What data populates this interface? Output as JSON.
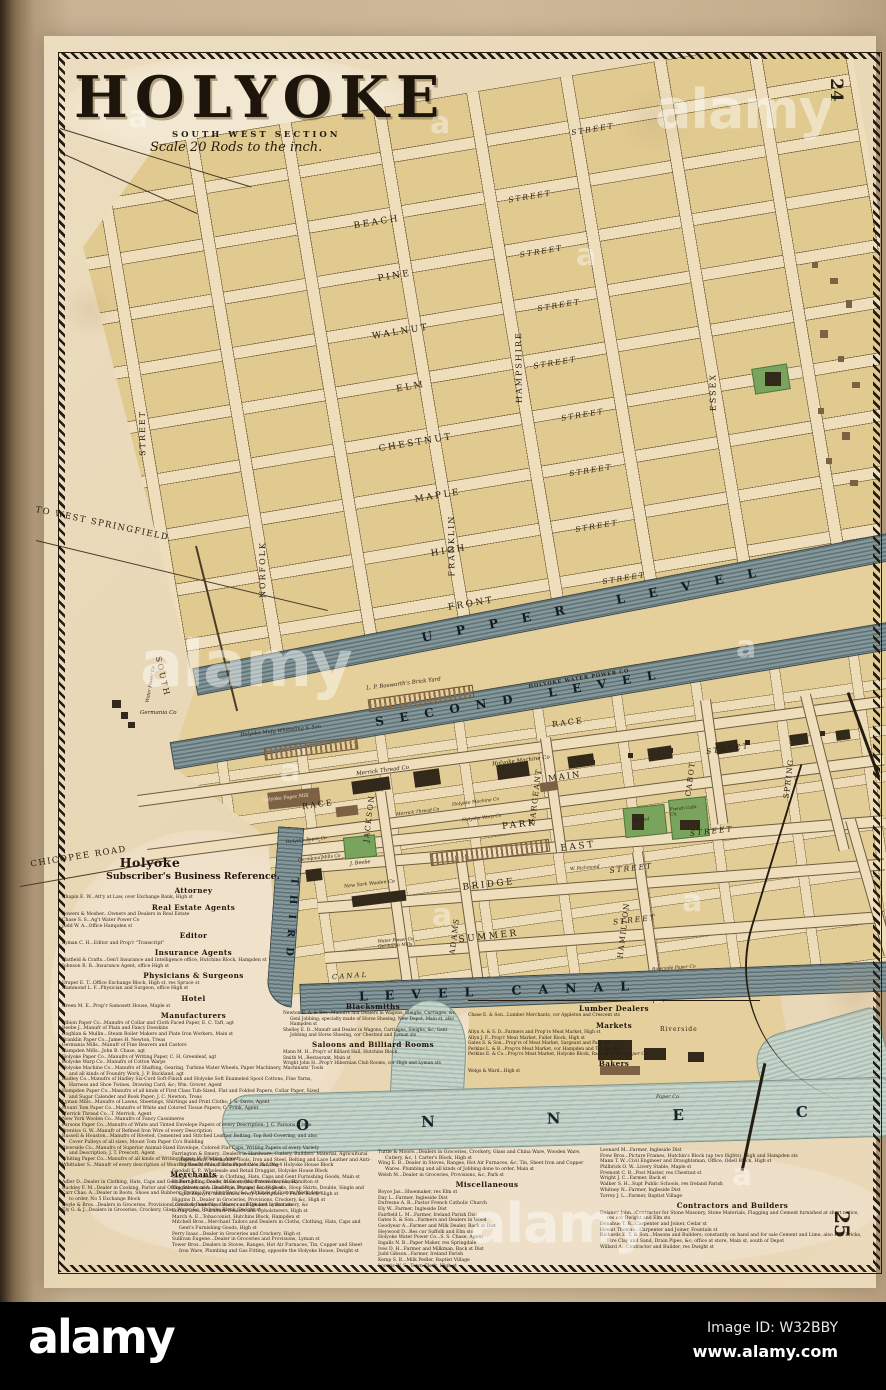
{
  "sheet": {
    "title": "HOLYOKE",
    "section": "SOUTH WEST SECTION",
    "scale": "Scale 20 Rods to the inch.",
    "page_top": "24",
    "page_bottom": "25"
  },
  "watermark": {
    "wordmark": "alamy",
    "glyph": "a",
    "image_id": "Image ID: W32BBY",
    "site": "www.alamy.com"
  },
  "map": {
    "rows": [
      {
        "s": "STREET"
      },
      {
        "n": "BEACH",
        "s": "STREET"
      },
      {
        "n": "PINE",
        "s": "STREET"
      },
      {
        "n": "WALNUT",
        "s": "STREET"
      },
      {
        "n": "ELM",
        "s": "STREET"
      },
      {
        "n": "CHESTNUT",
        "s": "STREET"
      },
      {
        "n": "MAPLE",
        "s": "STREET"
      },
      {
        "n": "HIGH",
        "s": "STREET"
      },
      {
        "n": "FRONT",
        "s": "STREET"
      }
    ],
    "cols": [
      "STREET",
      "NORFOLK",
      "FRANKLIN",
      "HAMPSHIRE",
      "ESSEX",
      "STREET"
    ],
    "lower_rows": [
      {
        "n": "PARK"
      },
      {
        "n": "EAST",
        "s": "STREET"
      },
      {
        "n": "BRIDGE",
        "s": "STREET"
      },
      {
        "n": "SUMMER",
        "s": "STREET"
      }
    ],
    "lower_cols": [
      "JACKSON",
      "SARGEANT",
      "ADAMS",
      "CABOT",
      "HAMILTON",
      "SPRING"
    ],
    "canals": {
      "upper": "UPPER LEVEL",
      "second": "SECOND LEVEL",
      "first": "LEVEL CANAL",
      "third": "THIRD",
      "canal_st": "CANAL"
    },
    "river_letters": "ONNEC",
    "roads": {
      "west_springfield": "TO WEST SPRINGFIELD",
      "chicopee": "CHICOPEE ROAD",
      "south": "SOUTH"
    },
    "streets_mid": {
      "race": "RACE",
      "race2": "RACE",
      "main": "MAIN",
      "main_st": "STREET"
    },
    "places": {
      "hwp": "HOLYOKE WATER POWER CO",
      "bosworth": "L. P. Bosworth's Brick Yard",
      "germania_co": "Germania Co",
      "holyoke_mnfg": "Holyoke Mnfg Whitteling & Son",
      "merrick": "Merrick Thread Co",
      "merrick2": "Merrick Thread Co",
      "machine": "Holyoke Machine Co",
      "machine2": "Holyoke Machine Co",
      "warp": "Holyoke Warp Co",
      "paper_mill": "Holyoke Paper Mill",
      "holyoke_paper": "Holyoke Paper Co",
      "germania_mills": "Germania Mills Co",
      "beebe": "J. Beebe",
      "ny_woolen": "New York Woolen Co",
      "wp_germania": "Water Power Co Germania Mills",
      "school": "School",
      "french_ch": "French Cath. Ch.",
      "franklin_paper": "Franklin Paper Co",
      "riverside_paper": "Riverside Paper Co",
      "riverside": "Riverside",
      "paper_co": "Paper Co",
      "water_power": "Water Power Co",
      "richmond": "W. Richmond"
    }
  },
  "directory": {
    "title": "Holyoke",
    "subtitle": "Subscriber's Business Reference.",
    "col_main": [
      {
        "h": "Attorney"
      },
      {
        "e": "Chapin E. W...Att'y at Law, over Exchange Bank, High st"
      },
      {
        "h": "Real Estate Agents"
      },
      {
        "e": "Bowers & Mosher...Owners and Dealers in Real Estate"
      },
      {
        "e": "Chase S. S...Ag't Water Power Co"
      },
      {
        "e": "Judd W. A...Office Hampden st"
      },
      {
        "h": "Editor"
      },
      {
        "e": "Lyman C. H...Editor and Prop'r \"Transcript\""
      },
      {
        "h": "Insurance Agents"
      },
      {
        "e": "Hatfield & Crafts...Gen'l Insurance and Intelligence office, Hutchins Block, Hampden st"
      },
      {
        "e": "Johnson R. B...Insurance Agent, office High st"
      },
      {
        "h": "Physicians & Surgeons"
      },
      {
        "e": "Draper E. T...Office Exchange Block, High st, res Spruce st"
      },
      {
        "e": "Hammond L. F...Physician and Surgeon, office High st"
      },
      {
        "h": "Hotel"
      },
      {
        "e": "Green M. E...Prop'r Samosett House, Maple st"
      },
      {
        "h": "Manufacturers"
      },
      {
        "e": "Albion Paper Co...Manufrs of Collar and Cloth Faced Paper, E. C. Taft, agt"
      },
      {
        "e": "Beebe J...Manufr of Plain and Fancy Doeskins"
      },
      {
        "e": "Coghlan & Mullin...Steam Boiler Makers and Plate Iron Workers, Main st"
      },
      {
        "e": "Franklin Paper Co...James H. Newton, Treas"
      },
      {
        "e": "Germania Mills...Manufr of Fine Beavers and Castors"
      },
      {
        "e": "Hampden Mills...John B. Chase, agt"
      },
      {
        "e": "Holyoke Paper Co...Manufrs of Writing Paper, C. H. Greenleaf, agt"
      },
      {
        "e": "Holyoke Warp Co...Manufrs of Cotton Warps"
      },
      {
        "e": "Holyoke Machine Co...Manufrs of Shafting, Gearing, Turbine Water Wheels, Paper Machinery, Machinists' Tools and all kinds of Foundry Work, J. P. Buckland, agt"
      },
      {
        "e": "Hadley Co...Manufrs of Hadley Six-Cord Soft-Finish and Holyoke Soft Enameled Spool Cottons, Fine Yarns, Harness and Shoe Twines, Drawing Card, &c; Wm. Grover, Agent"
      },
      {
        "e": "Hampden Paper Co...Manufrs of all kinds of First Class Tub-Sized, Flat and Folded Papers, Collar Paper, Sized and Sugar Calender and Book Paper; J. C. Newton, Treas"
      },
      {
        "e": "Lyman Mills...Manufrs of Lawns, Sheetings, Shirtings and Print Cloths; J. S. Davis, Agent"
      },
      {
        "e": "Mount Tom Paper Co...Manufrs of White and Colored Tissue Papers; C. Frink, Agent"
      },
      {
        "e": "Merrick Thread Co...T. Merrick, Agent"
      },
      {
        "e": "New York Woolen Co...Manufrs of Fancy Cassimeres"
      },
      {
        "e": "Parsons Paper Co...Manufrs of White and Tinted Envelope Papers of every Description; J. C. Parsons, Treas"
      },
      {
        "e": "Prentiss G. W...Manufr of Refined Iron Wire of every Description"
      },
      {
        "e": "Russell & Houston...Manufrs of Riveted, Cemented and Stitched Leather Belting, Top Roll Covering, and also Cover Pulleys of all sizes, Mount Tom Paper Co's Building"
      },
      {
        "e": "Riverside Co...Manufrs of Superior Animal-Sized Envelope, Colored Flat Caps, Writing Papers of every Variety and Description; J. T. Prescott, Agent"
      },
      {
        "e": "Whiting Paper Co...Manufrs of all kinds of Writing Paper; W. Whiting, Agent"
      },
      {
        "e": "Whittaker S...Manufr of every description of Weaving Reeds, Mount Tom Paper Co's Building"
      },
      {
        "h": "Merchants"
      },
      {
        "e": "Adler D...Dealer in Clothing, Hats, Caps and Gent Furnishing Goods, Main st, (third store from bank)"
      },
      {
        "e": "Buckley F. M...Dealer in Cooking, Parlor and Office Stoves, also Lead Pipe, Pumps, &c, High st"
      },
      {
        "e": "Carr Chas. A...Dealer in Boots, Shoes and Rubbers, Trunks, Traveling Bags, &c. All kinds of Custom Work done to order, No 5 Exchange Block"
      },
      {
        "e": "Doyle & Bros...Dealers in Groceries, Provisions, Crockery and Glass Ware, cor High and Lyman sts"
      },
      {
        "e": "Ely G. & J...Dealers in Groceries, Crockery, Glass Ware, &c, Holyoke Block, Dwight st"
      }
    ],
    "col_black": [
      {
        "h": "Blacksmiths"
      },
      {
        "e": "Newton E. A. & Bro...Manufrs and Dealers in Wagons, Sleighs, Carriages, &c. Genl Jobbing; specialty made of Horse Shoeing, New Depot, Main st, also Hampden st"
      },
      {
        "e": "Shelley E. D...Manufr and Dealer in Wagons, Carriages, Sleighs, &c, Genl Jobbing and Horse Shoeing, cor Chestnut and Lyman sts"
      },
      {
        "h": "Saloons and Billiard Rooms"
      },
      {
        "e": "Mann M. H...Prop'r of Billiard Hall, Hutchins Block"
      },
      {
        "e": "Smith M...Restaurant, Main st"
      },
      {
        "e": "Wright John H...Prop'r Hibernian Club Rooms, cor High and Lyman sts"
      }
    ],
    "col_lumber": [
      {
        "h": "Lumber Dealers"
      },
      {
        "e": "Chase E. & Son...Lumber Merchants, cor Appleton and Crescent sts"
      },
      {
        "h": "Markets"
      },
      {
        "e": "Allyn A. & S. D...Farmers and Prop'rs Meat Market, High st"
      },
      {
        "e": "Allyn J. F...Prop'r Meat Market, Fuller Block, High st"
      },
      {
        "e": "Gates S. & Son...Prop'rs of Meat Market, Sargeant and Park sts"
      },
      {
        "e": "Perkins L. & B...Prop'rs Meat Market, cor Hampden and Temple sts"
      },
      {
        "e": "Perkins E. & Co...Prop'rs Meat Market, Holyoke Block, Race st"
      },
      {
        "h": "Bakers"
      },
      {
        "e": "Welgs & Ward...High st"
      }
    ],
    "bottom_left": [
      {
        "e": "Farrington & Emery...Dealers in Hardware, Cutlery, Builders' Material, Agricultural Implements, Machinists' Tools, Iron and Steel, Belting and Lace Leather and Anti-Friction Metals, Fairbank's Scales, &c, No 4 Holyoke House Block"
      },
      {
        "e": "Goodall E. P...Wholesale and Retail Druggist, Holyoke House Block"
      },
      {
        "e": "Gough C. L...Dealer in Clothing, Hats, Caps and Gent Furnishing Goods, Main st"
      },
      {
        "e": "Halbert John...Dealer in Groceries, Provisions, &c, Hamilton st"
      },
      {
        "e": "Higginbottom A...Dealer in Dry and Fancy Goods, Hoop Skirts, Double, Single and Split Zephyrs, and Yarn of every Description, 1 Fuller Block, High st"
      },
      {
        "e": "Higgins D...Dealer in Groceries, Provisions, Crockery, &c, High st"
      },
      {
        "e": "Loomis & Pomeroy...Grocers and Dealers in Stationery, &c"
      },
      {
        "e": "Loring Bros...Furniture Dealers and Upholsterers, High st"
      },
      {
        "e": "March A. E...Tobacconist, Hutchins Block, Hampden st"
      },
      {
        "e": "Mitchell Bros...Merchant Tailors and Dealers in Cloths, Clothing, Hats, Caps and Gent's Furnishing Goods, High st"
      },
      {
        "e": "Perry Isaac...Dealer in Groceries and Crockery, High st"
      },
      {
        "e": "Sullivan Eugene...Dealer in Groceries and Provisions, Lyman st"
      },
      {
        "e": "Tower Bros...Dealers in Stoves, Ranges, Hot Air Furnaces, Tin, Copper and Sheet Iron Ware, Plumbing and Gas Fitting, opposite the Holyoke House, Dwight st"
      }
    ],
    "bottom_mid": [
      {
        "e": "Tuttle & Moore...Dealers in Groceries, Crockery, Glass and China Ware, Wooden Ware, Cutlery, &c, 1 Carter's Block, High st"
      },
      {
        "e": "Wing E. B...Dealer in Stoves, Ranges, Hot Air Furnaces, &c, Tin, Sheet Iron and Copper Wares. Plumbing and all kinds of Jobbing done to order, Main st"
      },
      {
        "e": "Welsh M...Dealer in Groceries, Provisions, &c, Park st"
      },
      {
        "h": "Miscellaneous"
      },
      {
        "e": "Boyce Jas...Shoemaker, res Elm st"
      },
      {
        "e": "Day L...Farmer, Ingleside Dist"
      },
      {
        "e": "Dufresne A. B...Pastor French Catholic Church"
      },
      {
        "e": "Ely W...Farmer, Ingleside Dist"
      },
      {
        "e": "Fairfield L. M...Farmer, Ireland Parish Dist"
      },
      {
        "e": "Gates S. & Son...Farmers and Dealers in Wood"
      },
      {
        "e": "Goodyear A...Farmer and Milk Dealer, Back st Dist"
      },
      {
        "e": "Heywood D...Res cor Suffolk and Elm sts"
      },
      {
        "e": "Holyoke Water Power Co...S. S. Chase, Agent"
      },
      {
        "e": "Ingalls N. B...Paper Maker, res Springdale"
      },
      {
        "e": "Ives D. H...Farmer and Milkman, Back st Dist"
      },
      {
        "e": "Judd Gibson...Farmer, Ireland Parish"
      },
      {
        "e": "Kemp S. B...Milk Pedler, Baptist Village"
      },
      {
        "e": "Loomis W. S...Town Clerk, High st"
      }
    ],
    "bottom_right": [
      {
        "e": "Leonard M...Farmer, Ingleside Dist"
      },
      {
        "e": "Frew Bros...Picture Frames, Hutchin's Block (up two flights), High and Hampden sts"
      },
      {
        "e": "Mann T. W...Civil Engineer and Draughtsman, Office, Odell Block, High st"
      },
      {
        "e": "Philbrick O. W...Livery Stable, Maple st"
      },
      {
        "e": "Fremont C. B...Post Master, res Chestnut st"
      },
      {
        "e": "Wright J. C...Farmer, Back st"
      },
      {
        "e": "Walker S. H...Supt Public Schools, res Ireland Parish"
      },
      {
        "e": "Whitney N...Farmer, Ingleside Dist"
      },
      {
        "e": "Torrey J. L...Farmer, Baptist Village"
      },
      {
        "h": "Contractors and Builders"
      },
      {
        "e": "Delaney John...Contractor for Stone Masonry, Stone Materials, Flagging and Cement furnished at short notice, res cor Dwight and Elm sts"
      },
      {
        "e": "Donahue T. B...Carpenter and Joiner, Cedar st"
      },
      {
        "e": "Howat Thomas...Carpenter and Joiner, Fountain st"
      },
      {
        "e": "Richards E. T. & Son...Masons and Builders; constantly on hand and for sale Cement and Lime, also Fire Bricks, Fire Clay and Sand, Drain Pipes, &c; office at store, Main st, south of Depot"
      },
      {
        "e": "Willard A...Contractor and Builder, res Dwight st"
      }
    ]
  }
}
